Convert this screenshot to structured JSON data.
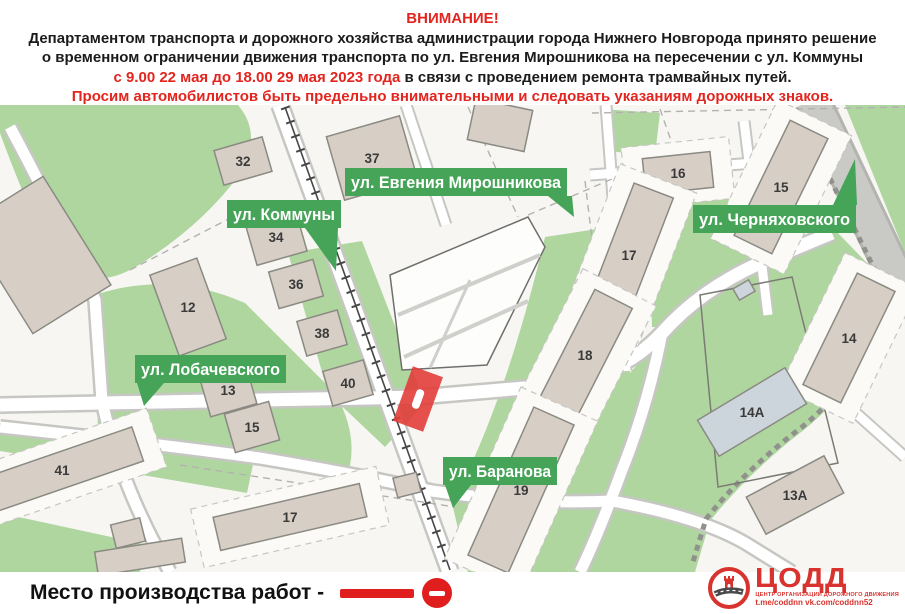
{
  "header": {
    "title": "ВНИМАНИЕ!",
    "line2": "Департаментом транспорта и дорожного хозяйства администрации города Нижнего Новгорода принято решение",
    "line3": "о временном ограничении движения транспорта по ул. Евгения Мирошникова на пересечении с ул. Коммуны",
    "line4_red": "с 9.00 22 мая до 18.00 29 мая 2023 года",
    "line4_black": " в связи с проведением ремонта трамвайных путей.",
    "line5": "Просим автомобилистов быть предельно внимательными и следовать указаниям дорожных знаков."
  },
  "map": {
    "street_labels": [
      {
        "name": "ул. Евгения Мирошникова",
        "x": 345,
        "y": 63,
        "w": 222,
        "h": 28,
        "pointer": "548,91 572,91 574,112"
      },
      {
        "name": "ул. Коммуны",
        "x": 227,
        "y": 95,
        "w": 114,
        "h": 28,
        "pointer": "305,123 338,123 336,166"
      },
      {
        "name": "ул. Черняховского",
        "x": 693,
        "y": 100,
        "w": 163,
        "h": 28,
        "pointer": "833,100 855,54 857,100"
      },
      {
        "name": "ул. Лобачевского",
        "x": 135,
        "y": 250,
        "w": 151,
        "h": 28,
        "pointer": "137,278 164,278 144,301"
      },
      {
        "name": "ул. Баранова",
        "x": 443,
        "y": 352,
        "w": 114,
        "h": 28,
        "pointer": "445,380 471,380 453,403"
      }
    ],
    "buildings": [
      {
        "label": "",
        "x": 38,
        "y": 150,
        "w": 92,
        "h": 128,
        "rot": -32
      },
      {
        "label": "32",
        "x": 243,
        "y": 56,
        "w": 50,
        "h": 36,
        "rot": -16
      },
      {
        "label": "37",
        "x": 372,
        "y": 53,
        "w": 76,
        "h": 66,
        "rot": -16
      },
      {
        "label": "",
        "x": 500,
        "y": 20,
        "w": 58,
        "h": 42,
        "rot": 12
      },
      {
        "label": "34",
        "x": 276,
        "y": 132,
        "w": 52,
        "h": 44,
        "rot": -16
      },
      {
        "label": "36",
        "x": 296,
        "y": 179,
        "w": 46,
        "h": 38,
        "rot": -16
      },
      {
        "label": "12",
        "x": 188,
        "y": 202,
        "w": 50,
        "h": 86,
        "rot": -20
      },
      {
        "label": "38",
        "x": 322,
        "y": 228,
        "w": 42,
        "h": 36,
        "rot": -16
      },
      {
        "label": "40",
        "x": 348,
        "y": 278,
        "w": 42,
        "h": 36,
        "rot": -16
      },
      {
        "label": "13",
        "x": 228,
        "y": 285,
        "w": 48,
        "h": 42,
        "rot": -16
      },
      {
        "label": "15",
        "x": 252,
        "y": 322,
        "w": 46,
        "h": 40,
        "rot": -16
      },
      {
        "label": "41",
        "x": 62,
        "y": 365,
        "w": 160,
        "h": 36,
        "rot": -19,
        "lot": true
      },
      {
        "label": "17",
        "x": 290,
        "y": 412,
        "w": 150,
        "h": 34,
        "rot": -13,
        "lot": true
      },
      {
        "label": "",
        "x": 128,
        "y": 428,
        "w": 30,
        "h": 24,
        "rot": -14
      },
      {
        "label": "",
        "x": 140,
        "y": 452,
        "w": 88,
        "h": 24,
        "rot": -9
      },
      {
        "label": "",
        "x": 407,
        "y": 380,
        "w": 24,
        "h": 20,
        "rot": -14
      },
      {
        "label": "16",
        "x": 678,
        "y": 68,
        "w": 68,
        "h": 36,
        "rot": -6,
        "lot": true
      },
      {
        "label": "15",
        "x": 781,
        "y": 82,
        "w": 42,
        "h": 128,
        "rot": 26,
        "lot": true
      },
      {
        "label": "17",
        "x": 629,
        "y": 150,
        "w": 42,
        "h": 138,
        "rot": 21,
        "lot": true
      },
      {
        "label": "14",
        "x": 849,
        "y": 233,
        "w": 42,
        "h": 124,
        "rot": 26,
        "lot": true
      },
      {
        "label": "18",
        "x": 585,
        "y": 250,
        "w": 42,
        "h": 126,
        "rot": 27,
        "lot": true
      },
      {
        "label": "19",
        "x": 521,
        "y": 385,
        "w": 44,
        "h": 162,
        "rot": 24,
        "lot": true
      },
      {
        "label": "",
        "x": 744,
        "y": 185,
        "w": 18,
        "h": 13,
        "rot": -30,
        "color": "#ccd5db"
      },
      {
        "label": "14А",
        "x": 752,
        "y": 307,
        "w": 102,
        "h": 42,
        "rot": -31,
        "color": "#ccd5db"
      },
      {
        "label": "13А",
        "x": 795,
        "y": 390,
        "w": 88,
        "h": 42,
        "rot": -28
      }
    ]
  },
  "legend": {
    "label": "Место производства работ  -"
  },
  "logo": {
    "title": "ЦОДД",
    "subtitle": "ЦЕНТР ОРГАНИЗАЦИИ ДОРОЖНОГО ДВИЖЕНИЯ",
    "links": "t.me/coddnn vk.com/coddnn52"
  },
  "colors": {
    "header_red": "#e3251f",
    "banner_green": "#45a457",
    "map_green": "#b0d6a0",
    "building_fill": "#d7cfc6",
    "building_stroke": "#8a8a83",
    "lot_fill": "#fbfaf7",
    "lot_stroke": "#c6c6c2",
    "marker_red": "#e23d3a",
    "legend_red": "#e01e1e",
    "logo_red": "#d8332e"
  }
}
